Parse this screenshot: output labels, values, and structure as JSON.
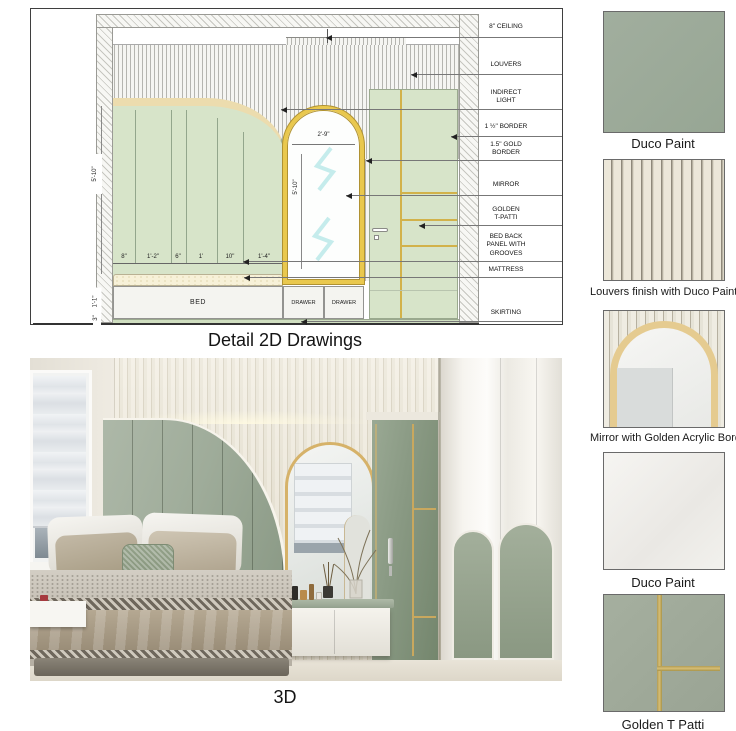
{
  "drawing2d": {
    "caption": "Detail 2D Drawings",
    "annotations": [
      "8\" CEILING",
      "LOUVERS",
      "INDIRECT\nLIGHT",
      "1 ½\" BORDER",
      "1.5\" GOLD\nBORDER",
      "MIRROR",
      "GOLDEN\nT-PATTI",
      "BED BACK\nPANEL WITH\nGROOVES",
      "MATTRESS",
      "SKIRTING"
    ],
    "bottom_dims": [
      "8\"",
      "1'-2\"",
      "6\"",
      "1'",
      "10\"",
      "1'-4\""
    ],
    "left_dims": {
      "panel_height": "5'-10\"",
      "bed_height": "1'-1\"",
      "skirting_height": "3\""
    },
    "mirror_dims": {
      "width": "2'-9\"",
      "height": "5'-10\""
    },
    "furniture": {
      "bed": "BED",
      "drawer_left": "DRAWER",
      "drawer_right": "DRAWER"
    }
  },
  "render3d": {
    "caption": "3D"
  },
  "materials": [
    {
      "caption": "Duco Paint"
    },
    {
      "caption": "Louvers finish with Duco Paint"
    },
    {
      "caption": "Mirror with Golden Acrylic Border"
    },
    {
      "caption": "Duco Paint"
    },
    {
      "caption": "Golden T Patti"
    }
  ],
  "colors": {
    "sage_2d": "#d7e4c9",
    "sage_3d": "#9dab9b",
    "gold": "#d8b75a",
    "beige_band": "#ecdcae",
    "louver_cream": "#ece7d9",
    "wall_cream": "#eae5db"
  }
}
